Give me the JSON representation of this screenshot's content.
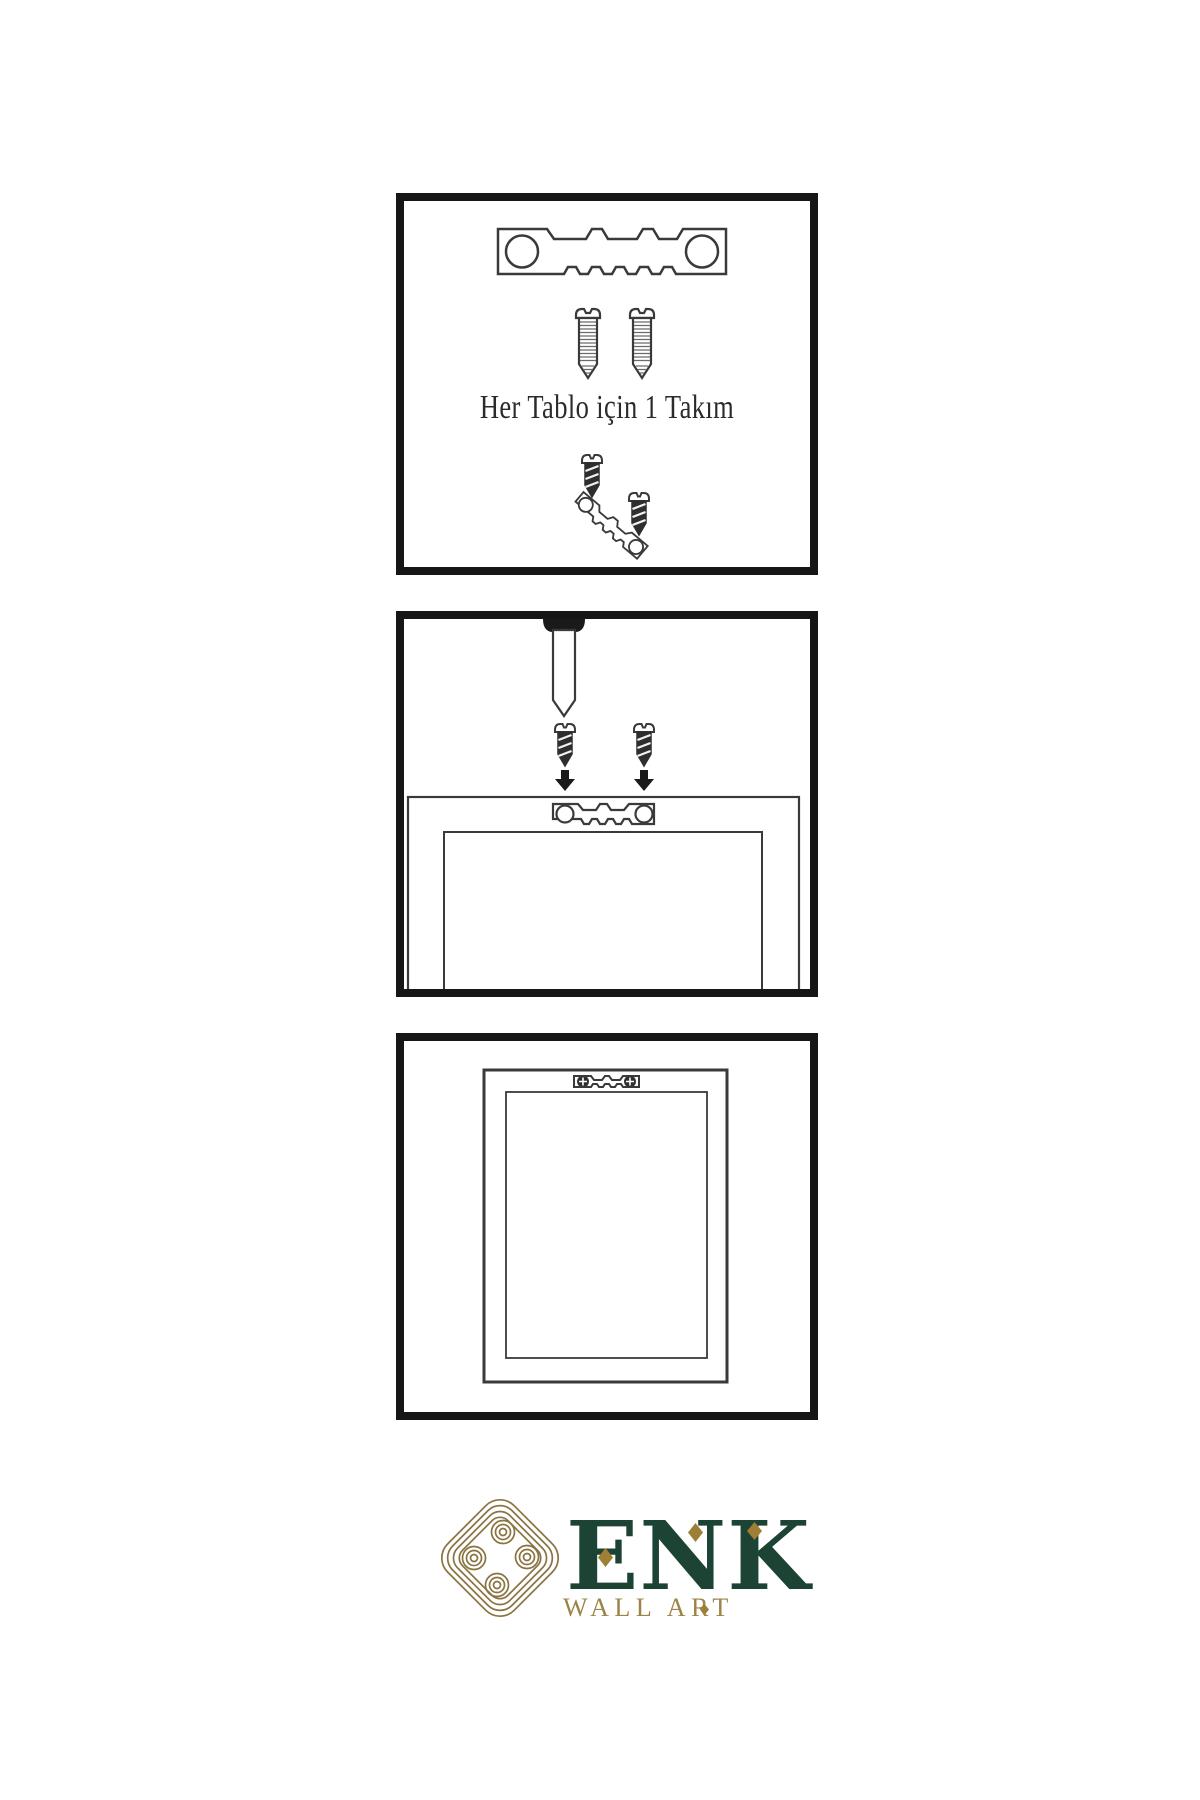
{
  "page": {
    "background": "#ffffff"
  },
  "colors": {
    "paper": "#ffffff",
    "panel_border": "#161616",
    "line_ink": "#3a3a3a",
    "dark_metal": "#2e2e2e",
    "thread": "#6a6a6a",
    "arrow": "#1a1a1a",
    "caption": "#2b2b2b",
    "brand_green": "#1d4334",
    "brand_gold": "#9c8348",
    "knot_gold": "#8a7340",
    "diamond_gold": "#9d7f35"
  },
  "steps": [
    {
      "caption": "Her Tablo için 1 Takım",
      "illustrations": [
        "sawtooth-hanger",
        "mounting-screw",
        "mounting-screw",
        "screw-and-angled-hanger-set"
      ]
    },
    {
      "caption": "",
      "illustrations": [
        "wall-nail",
        "screw-with-arrow",
        "screw-with-arrow",
        "frame-back-with-sawtooth-hanger"
      ]
    },
    {
      "caption": "",
      "illustrations": [
        "hung-frame-front-with-installed-hanger"
      ]
    }
  ],
  "brand": {
    "name": "ENK",
    "subtitle": "WALL ART",
    "logo_icon": "interlaced-knot-icon"
  }
}
